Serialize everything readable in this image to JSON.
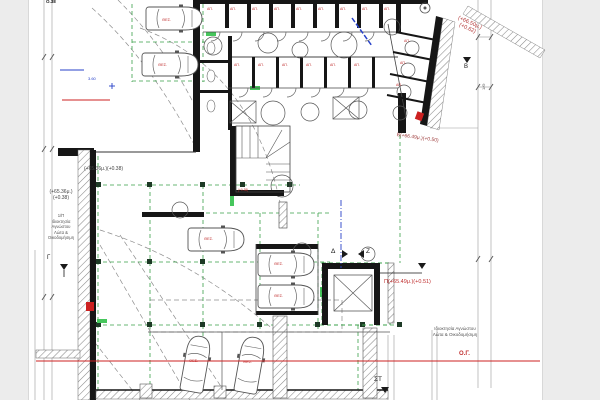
{
  "annotations": {
    "top_cut": "Ο.38",
    "corner_level_line1": "(+66.50μ.)",
    "corner_level_line2": "(+0.62)",
    "diagonal_level": "Β(+66.49μ.)(+0.50)",
    "mid_level": "Π(+65.49μ.)(+0.51)",
    "left_level_line1": "(+65.36μ.)",
    "left_level_line2": "(+0.38)",
    "inner_level": "(+65.36μ.)(+0.38)",
    "stair_level": "(+0.38)",
    "building_line_label": "Ο.Γ.",
    "blue_dim": "3.60",
    "dim_label": "1/Θ"
  },
  "property_left": {
    "line1": "1/Π",
    "line2": "Ιδιοκτησία",
    "line3": "Αγνώστου",
    "line4": "Λώτα &",
    "line5": "Οικοδομήσιμη"
  },
  "property_right": {
    "line1": "Ιδιοκτησία Αγνώστου",
    "line2": "Λώτα & Οικοδομήσιμη"
  },
  "markers": {
    "b": "Β",
    "g": "Γ",
    "d": "Δ",
    "z": "Ζ",
    "st": "ΣΤ"
  },
  "room_labels": {
    "storage": "ΑΠ.",
    "parking": "ΘΕΣ."
  },
  "colors": {
    "wall": "#161616",
    "green_dash": "#3aa04a",
    "column_green": "#1e3a26",
    "door_green": "#46c65c",
    "level_red": "#c03030",
    "line_red": "#cc2020",
    "blue": "#2741c9"
  }
}
